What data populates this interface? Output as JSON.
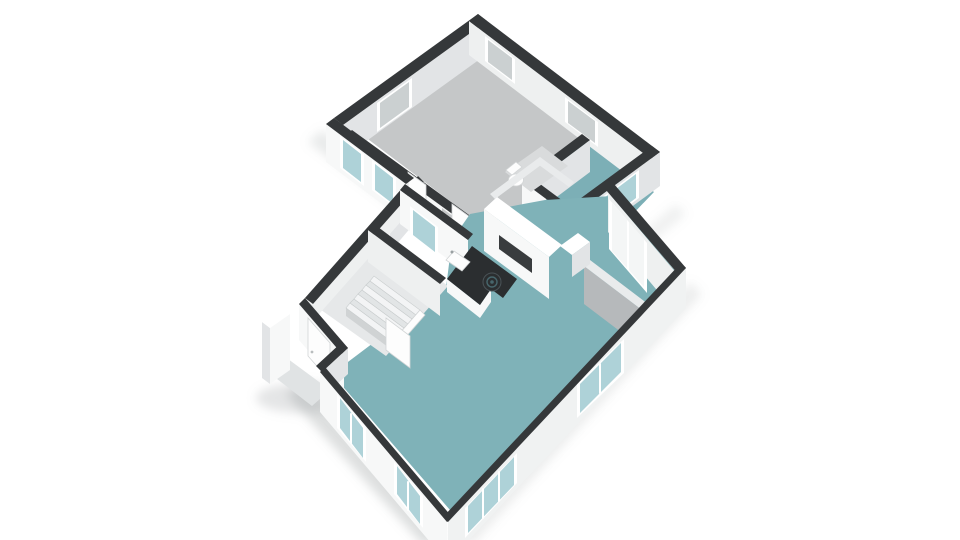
{
  "scene": {
    "alt": "3D isometric cutaway render of a single-storey house floor plan on a white background",
    "style": "white walls with dark charcoal wall tops, teal and grey floors, no text labels",
    "rooms": {
      "teal_floor": [
        "living room with open kitchen",
        "bathroom"
      ],
      "grey_floor": [
        "large bedroom",
        "two small rooms",
        "hallway",
        "wc"
      ],
      "white_floor": [
        "entry hall with staircase"
      ]
    },
    "furniture": [
      "kitchen island with sink and cooktop",
      "tall kitchen cabinet with dark niche",
      "small counter",
      "toilet",
      "staircase"
    ],
    "features": [
      "exterior windows with teal glass",
      "interior windows with grey glass",
      "large glass door",
      "entry door with white porch screen"
    ]
  },
  "colors": {
    "capDark": "#35383a",
    "capSoft": "#e9ebec",
    "faceBright": "#f7f8f8",
    "faceLight": "#eef0f0",
    "faceMid": "#e2e4e6",
    "faceShade": "#b6b9bb",
    "faceSE": "#f0f2f2",
    "floorGray": "#c5c7c8",
    "floorTeal": "#7fb2b8",
    "floorBath": "#7cafb6",
    "floorEntry": "#e6e8e9",
    "floorWc": "#d9dbdc",
    "glassTeal": "#aed2d8",
    "glassGray": "#cbd0d1",
    "glassWhite": "#f4f6f6",
    "frameWhite": "#ffffff",
    "furnitureWhite": "#fdfdfd",
    "islandTop": "#2b2e30",
    "nicheDark": "#393c3e",
    "shadow": "#8f9496",
    "background": "#ffffff"
  }
}
